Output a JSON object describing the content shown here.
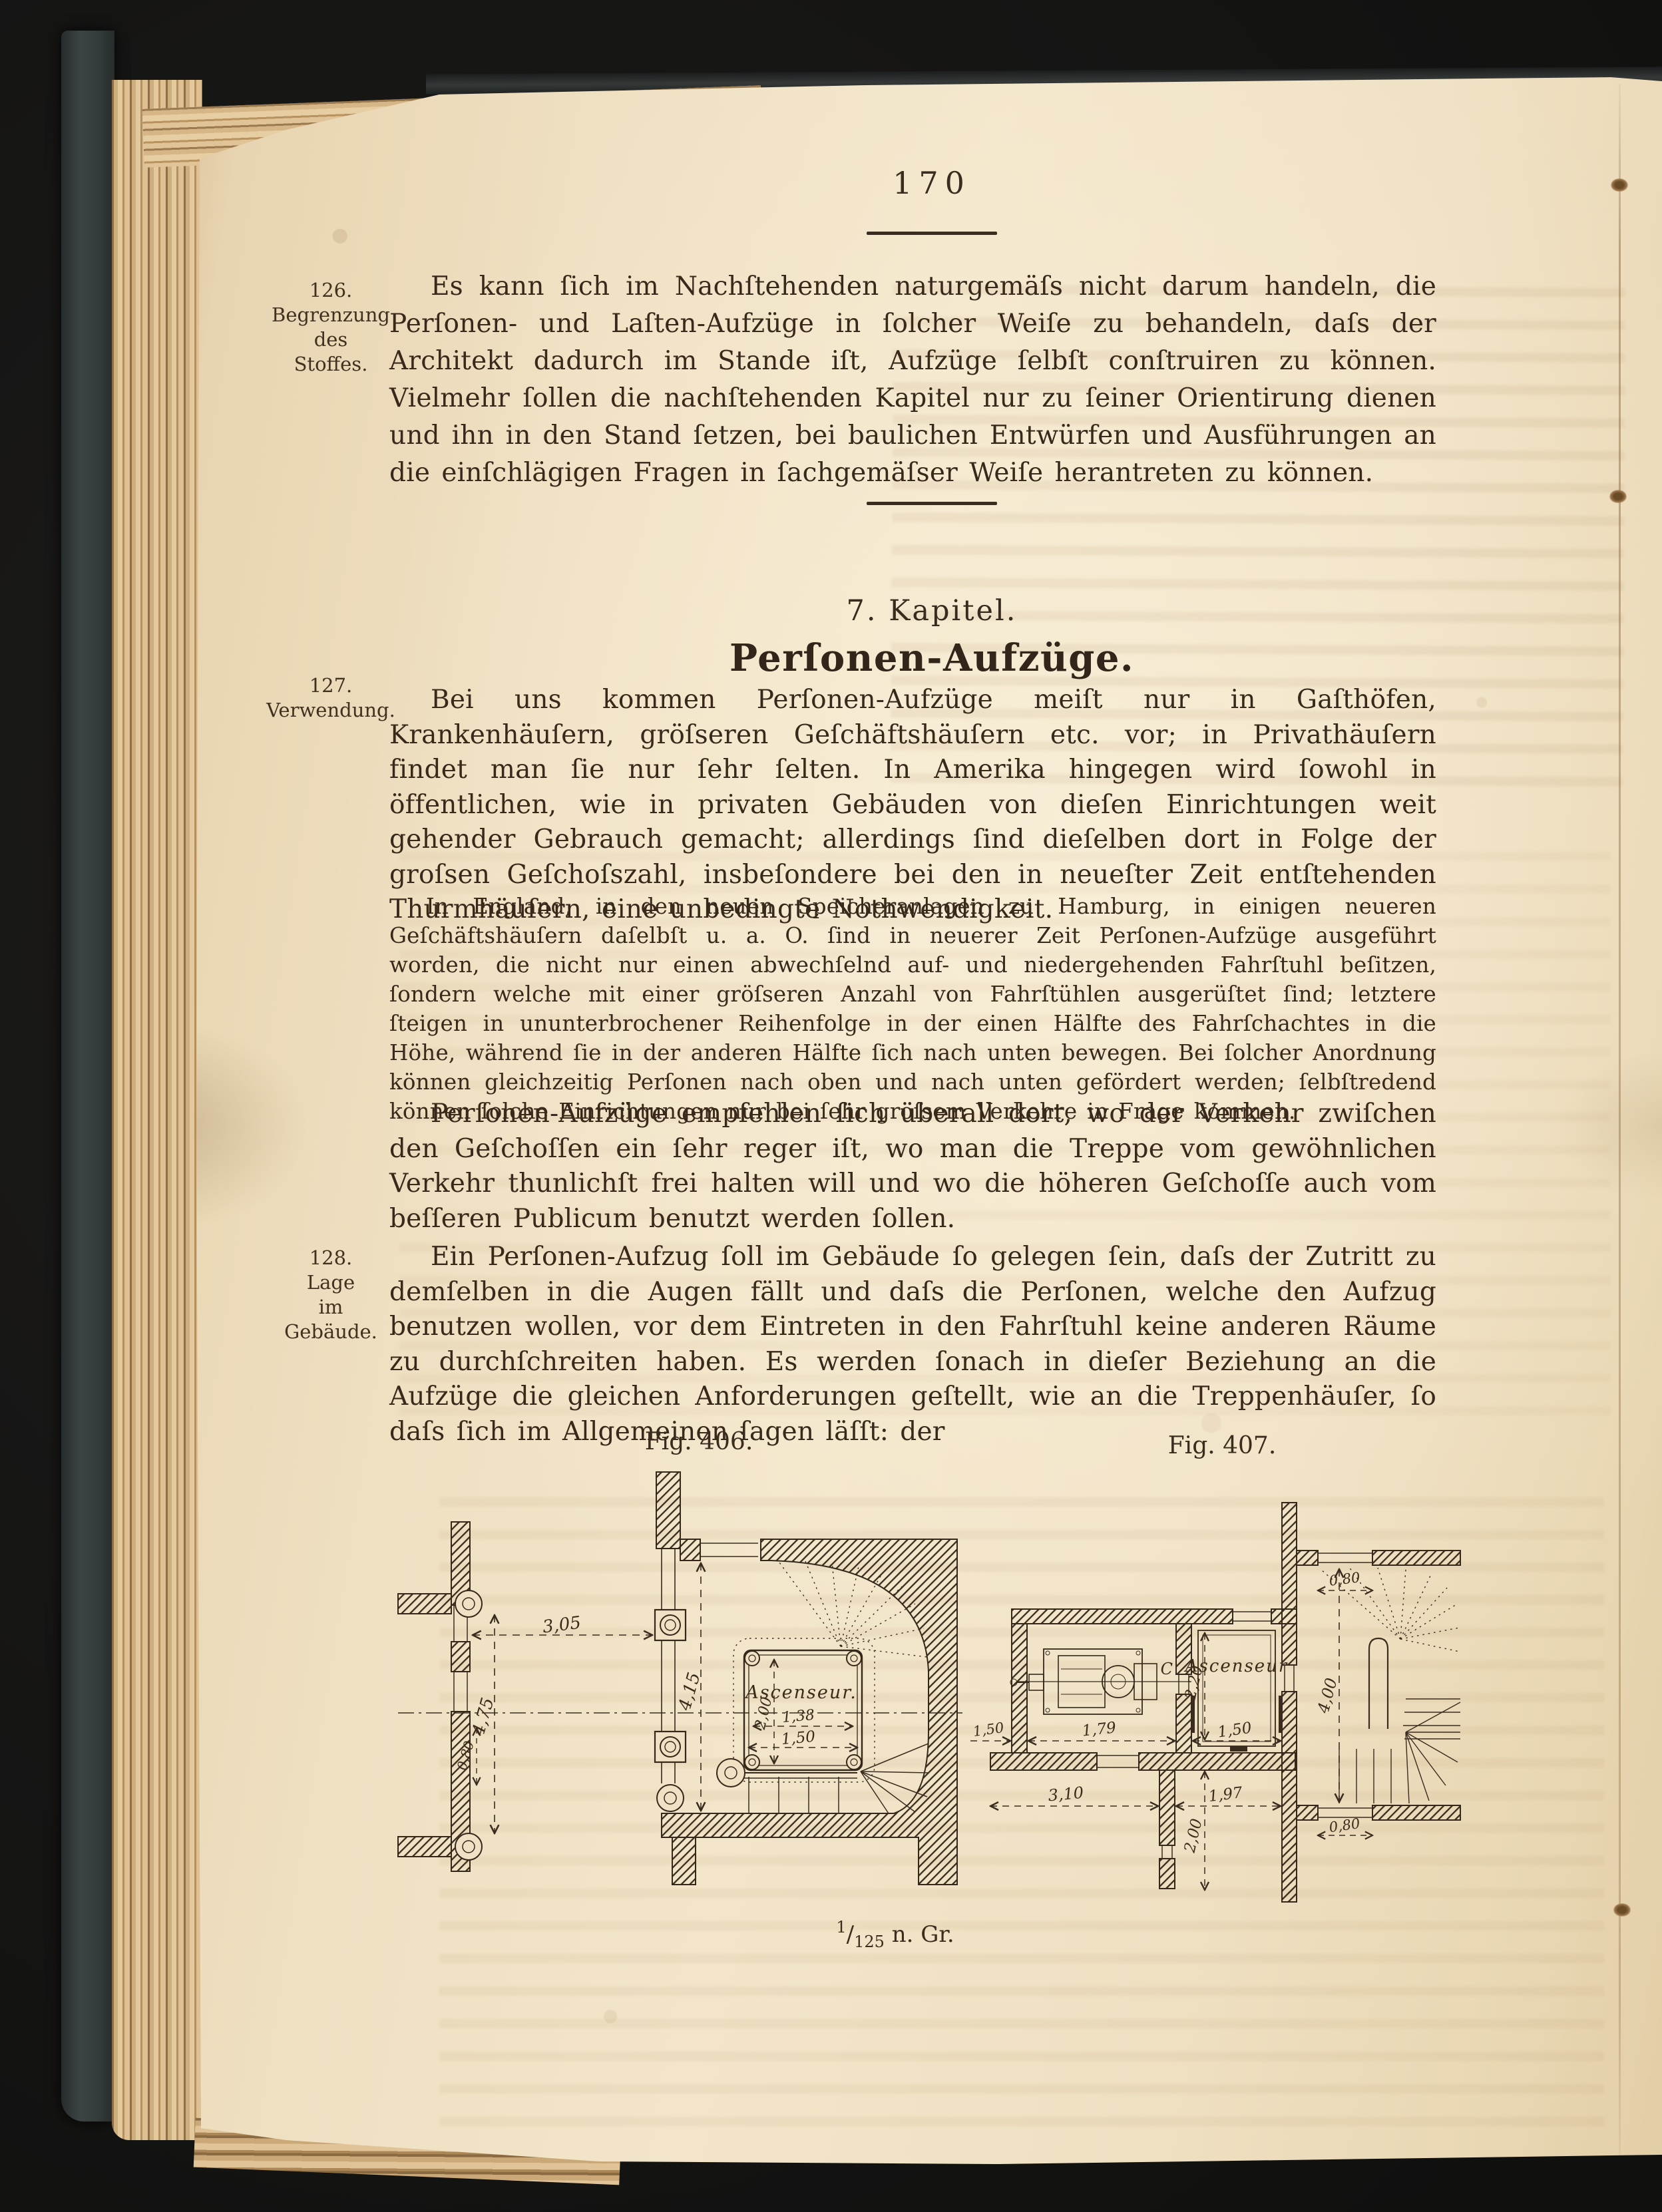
{
  "page": {
    "number": "170",
    "scale": {
      "num": "1",
      "sep": "/",
      "den": "125",
      "suffix": "n. Gr."
    }
  },
  "margin_notes": [
    {
      "lines": [
        "126.",
        "Begrenzung",
        "des",
        "Stoffes."
      ]
    },
    {
      "lines": [
        "127.",
        "Verwendung."
      ]
    },
    {
      "lines": [
        "128.",
        "Lage",
        "im",
        "Gebäude."
      ]
    }
  ],
  "heading": {
    "kicker": "7. Kapitel.",
    "title": "Perſonen-Aufzüge."
  },
  "paragraphs": {
    "p1": "Es kann ſich im Nachſtehenden naturgemäſs nicht darum handeln, die Perſonen- und Laſten-Aufzüge in ſolcher Weiſe zu behandeln, daſs der Architekt dadurch im Stande iſt, Aufzüge ſelbſt conſtruiren zu können. Vielmehr ſollen die nachſtehenden Kapitel nur zu ſeiner Orientirung dienen und ihn in den Stand ſetzen, bei baulichen Entwürfen und Ausführungen an die einſchlägigen Fragen in ſachgemäſser Weiſe herantreten zu können.",
    "p2": "Bei uns kommen Perſonen-Aufzüge meiſt nur in Gaſthöfen, Krankenhäuſern, gröſseren Geſchäftshäuſern etc. vor; in Privathäuſern findet man ſie nur ſehr ſelten. In Amerika hingegen wird ſowohl in öffentlichen, wie in privaten Gebäuden von dieſen Einrichtungen weit gehender Gebrauch gemacht; allerdings ſind dieſelben dort in Folge der groſsen Geſchoſszahl, insbeſondere bei den in neueſter Zeit entſtehenden Thurmhäuſern, eine unbedingte Nothwendigkeit.",
    "note": "In England, in den neuen Speicheranlagen zu Hamburg, in einigen neueren Geſchäftshäuſern daſelbſt u. a. O. ſind in neuerer Zeit Perſonen-Aufzüge ausgeführt worden, die nicht nur einen abwechſelnd auf- und niedergehenden Fahrſtuhl beſitzen, ſondern welche mit einer gröſseren Anzahl von Fahrſtühlen ausgerüſtet ſind; letztere ſteigen in ununterbrochener Reihenfolge in der einen Hälfte des Fahrſchachtes in die Höhe, während ſie in der anderen Hälfte ſich nach unten bewegen. Bei ſolcher Anordnung können gleichzeitig Perſonen nach oben und nach unten gefördert werden; ſelbſtredend können ſolche Einrichtungen nur bei ſehr groſsem Verkehre in Frage kommen.",
    "p3": "Perſonen-Aufzüge empfehlen ſich überall dort, wo der Verkehr zwiſchen den Geſchoſſen ein ſehr reger iſt, wo man die Treppe vom gewöhnlichen Verkehr thunlichſt frei halten will und wo die höheren Geſchoſſe auch vom beſſeren Publicum benutzt werden ſollen.",
    "p4": "Ein Perſonen-Aufzug ſoll im Gebäude ſo gelegen ſein, daſs der Zutritt zu demſelben in die Augen fällt und daſs die Perſonen, welche den Aufzug benutzen wollen, vor dem Eintreten in den Fahrſtuhl keine anderen Räume zu durchſchreiten haben. Es werden ſonach in dieſer Beziehung an die Aufzüge die gleichen Anforderungen geſtellt, wie an die Treppenhäuſer, ſo daſs ſich im Allgemeinen ſagen läſſt: der"
  },
  "figures": {
    "fig406": {
      "caption": "Fig. 406.",
      "shaft_label": "Ascenseur.",
      "dims": {
        "hall_width": "3,05",
        "hall_depth": "4,15",
        "bay_left": "4,75",
        "wall_offset": "0,80",
        "cab_depth": "2,00",
        "cab_width_inner": "1,38",
        "cab_width_outer": "1,50"
      }
    },
    "fig407": {
      "caption": "Fig. 407.",
      "shaft_label": "Ascenseur",
      "machine_label": "C",
      "dims": {
        "room_left": "1,50",
        "room_width": "1,79",
        "shaft_width": "1,50",
        "shaft_depth": "2,20",
        "corridor_left": "3,10",
        "corridor_right": "1,97",
        "corridor_depth": "2,00",
        "stair_depth": "4,00",
        "door_top": "0,80",
        "door_bottom": "0,80"
      }
    }
  }
}
